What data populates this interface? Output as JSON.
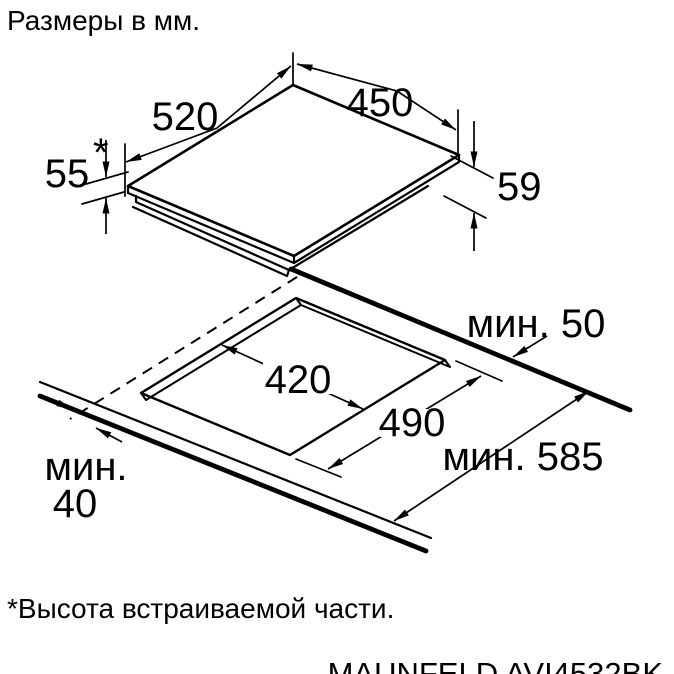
{
  "title": "Размеры в мм.",
  "footnote": "*Высота встраиваемой части.",
  "model": "MAUNFELD AVI4532BK",
  "hob": {
    "depth": "520",
    "width": "450",
    "built_in_height": "55",
    "asterisk": "*",
    "total_height": "59"
  },
  "cutout": {
    "width": "420",
    "depth": "490",
    "min_rear": "мин. 50",
    "min_depth": "мин. 585",
    "min_front_label": "мин.",
    "min_front_value": "40"
  }
}
